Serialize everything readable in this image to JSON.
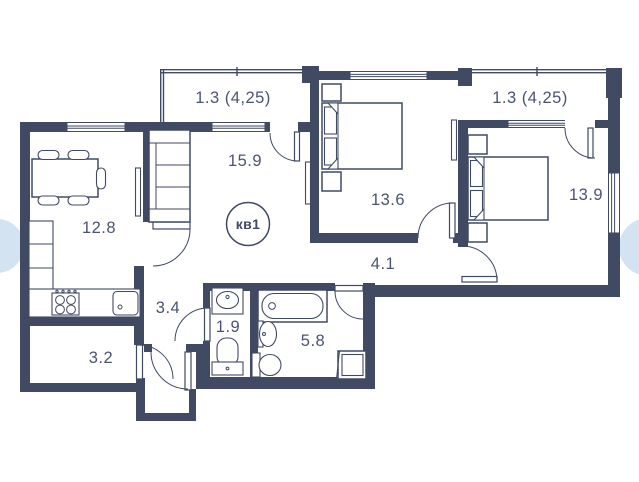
{
  "plan": {
    "type": "apartment-floor-plan",
    "apartment_label": "кв1",
    "rooms": [
      {
        "id": "balcony-top-left",
        "label": "1.3 (4,25)"
      },
      {
        "id": "balcony-top-right",
        "label": "1.3 (4,25)"
      },
      {
        "id": "living-room",
        "label": "15.9"
      },
      {
        "id": "bedroom-1",
        "label": "13.6"
      },
      {
        "id": "bedroom-2",
        "label": "13.9"
      },
      {
        "id": "kitchen-dining",
        "label": "12.8"
      },
      {
        "id": "hallway",
        "label": "4.1"
      },
      {
        "id": "corridor",
        "label": "3.4"
      },
      {
        "id": "wc",
        "label": "1.9"
      },
      {
        "id": "bathroom",
        "label": "5.8"
      },
      {
        "id": "storage",
        "label": "3.2"
      }
    ],
    "colors": {
      "wall": "#414a63",
      "label": "#4a5470",
      "edge_dot": "#d4e3f1",
      "background": "#ffffff"
    }
  }
}
